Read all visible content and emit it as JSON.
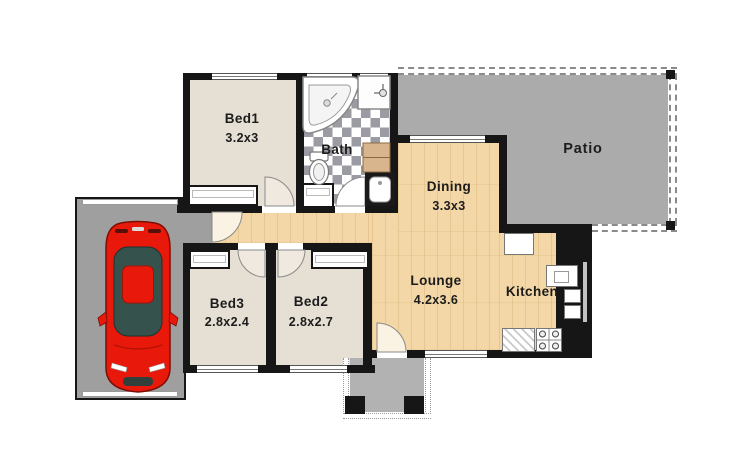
{
  "rooms": {
    "bed1": {
      "name": "Bed1",
      "size": "3.2x3"
    },
    "bed2": {
      "name": "Bed2",
      "size": "2.8x2.7"
    },
    "bed3": {
      "name": "Bed3",
      "size": "2.8x2.4"
    },
    "bath": {
      "name": "Bath"
    },
    "dining": {
      "name": "Dining",
      "size": "3.3x3"
    },
    "lounge": {
      "name": "Lounge",
      "size": "4.2x3.6"
    },
    "kitchen": {
      "name": "Kitchen"
    },
    "patio": {
      "name": "Patio"
    }
  },
  "colors": {
    "wall": "#161616",
    "wood_floor": "#f3d7a6",
    "bedroom_floor": "#e5dfd4",
    "tile_gray": "#9b9ba3",
    "garage_gray": "#9f9f9f",
    "patio_gray": "#ababab",
    "porch_gray": "#b2b2b2",
    "car_red": "#e8190b"
  }
}
